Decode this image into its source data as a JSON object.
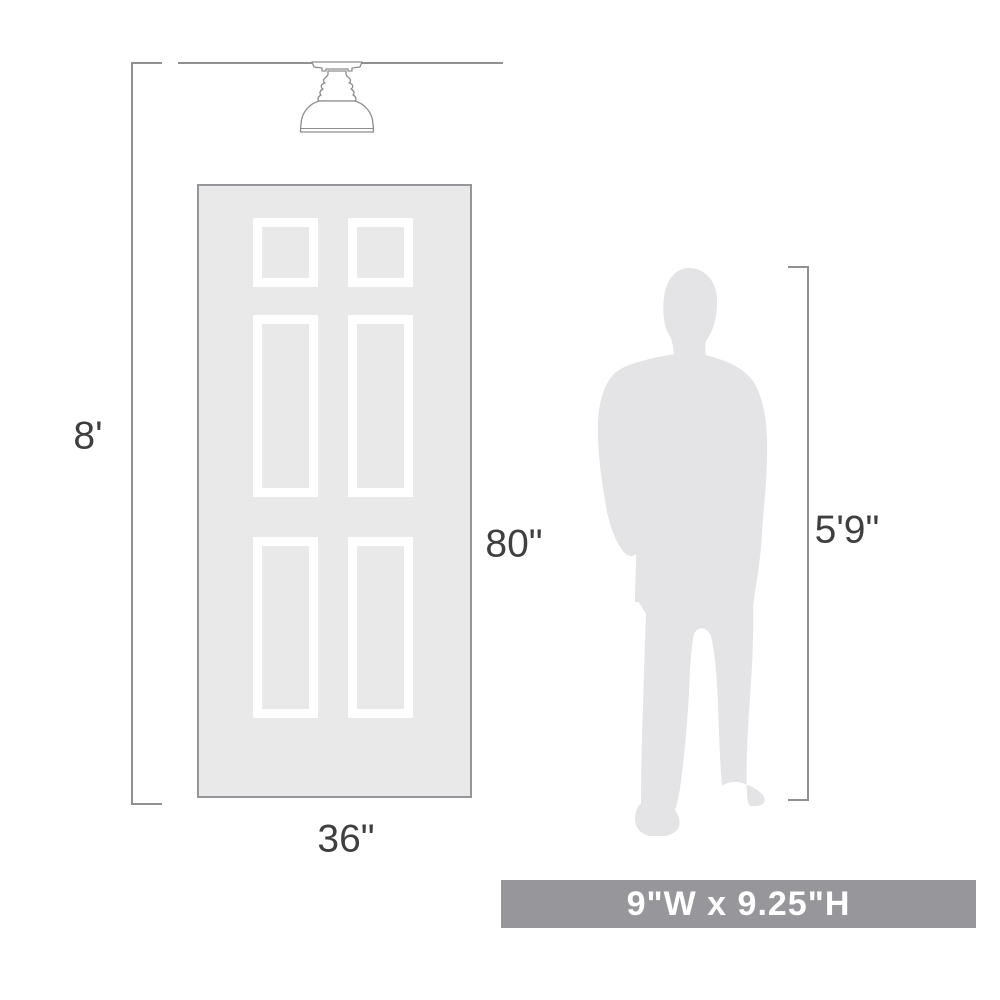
{
  "diagram": {
    "ceiling_height_label": "8'",
    "door_height_label": "80\"",
    "door_width_label": "36\"",
    "person_height_label": "5'9\"",
    "fixture_size_label": "9\"W x 9.25\"H",
    "icons": {
      "fixture": "semi-flush-ceiling-light-icon",
      "door": "six-panel-door-graphic",
      "person": "man-silhouette-icon"
    }
  },
  "colors": {
    "door_fill": "#e9e9ea",
    "door_border": "#95959a",
    "panel_frame": "#ffffff",
    "silhouette_fill": "#e4e4e6",
    "dimension_line": "#909090",
    "label_text": "#3f3f3f",
    "banner_bg": "#97979b",
    "banner_text": "#ffffff",
    "fixture_stroke": "#8d8d8d"
  }
}
